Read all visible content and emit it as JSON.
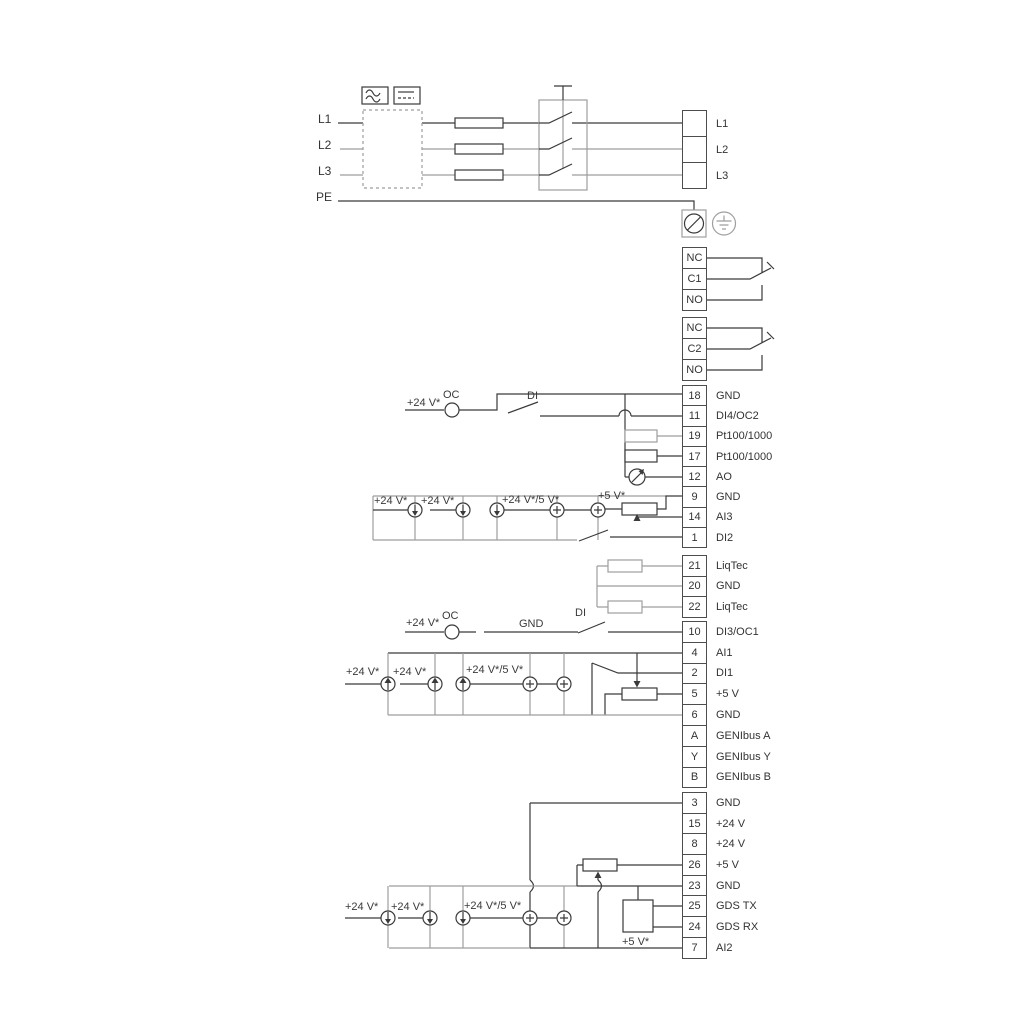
{
  "colors": {
    "line_dark": "#3a3a3a",
    "line_gray": "#9e9e9e"
  },
  "power": {
    "left": [
      "L1",
      "L2",
      "L3",
      "PE"
    ],
    "right": [
      "L1",
      "L2",
      "L3"
    ]
  },
  "relay1": [
    "NC",
    "C1",
    "NO"
  ],
  "relay2": [
    "NC",
    "C2",
    "NO"
  ],
  "io1": [
    {
      "n": "18",
      "l": "GND"
    },
    {
      "n": "11",
      "l": "DI4/OC2"
    },
    {
      "n": "19",
      "l": "Pt100/1000"
    },
    {
      "n": "17",
      "l": "Pt100/1000"
    },
    {
      "n": "12",
      "l": "AO"
    },
    {
      "n": "9",
      "l": "GND"
    },
    {
      "n": "14",
      "l": "AI3"
    },
    {
      "n": "1",
      "l": "DI2"
    }
  ],
  "liqtec": [
    {
      "n": "21",
      "l": "LiqTec"
    },
    {
      "n": "20",
      "l": "GND"
    },
    {
      "n": "22",
      "l": "LiqTec"
    }
  ],
  "io2": [
    {
      "n": "10",
      "l": "DI3/OC1"
    },
    {
      "n": "4",
      "l": "AI1"
    },
    {
      "n": "2",
      "l": "DI1"
    },
    {
      "n": "5",
      "l": "+5 V"
    },
    {
      "n": "6",
      "l": "GND"
    },
    {
      "n": "A",
      "l": "GENIbus A"
    },
    {
      "n": "Y",
      "l": "GENIbus Y"
    },
    {
      "n": "B",
      "l": "GENIbus B"
    }
  ],
  "io3": [
    {
      "n": "3",
      "l": "GND"
    },
    {
      "n": "15",
      "l": "+24 V"
    },
    {
      "n": "8",
      "l": "+24 V"
    },
    {
      "n": "26",
      "l": "+5 V"
    },
    {
      "n": "23",
      "l": "GND"
    },
    {
      "n": "25",
      "l": "GDS TX"
    },
    {
      "n": "24",
      "l": "GDS RX"
    },
    {
      "n": "7",
      "l": "AI2"
    }
  ],
  "labels": {
    "v24": "+24 V*",
    "v24_5": "+24 V*/5 V*",
    "v5": "+5 V*",
    "oc": "OC",
    "di": "DI",
    "gnd": "GND"
  }
}
